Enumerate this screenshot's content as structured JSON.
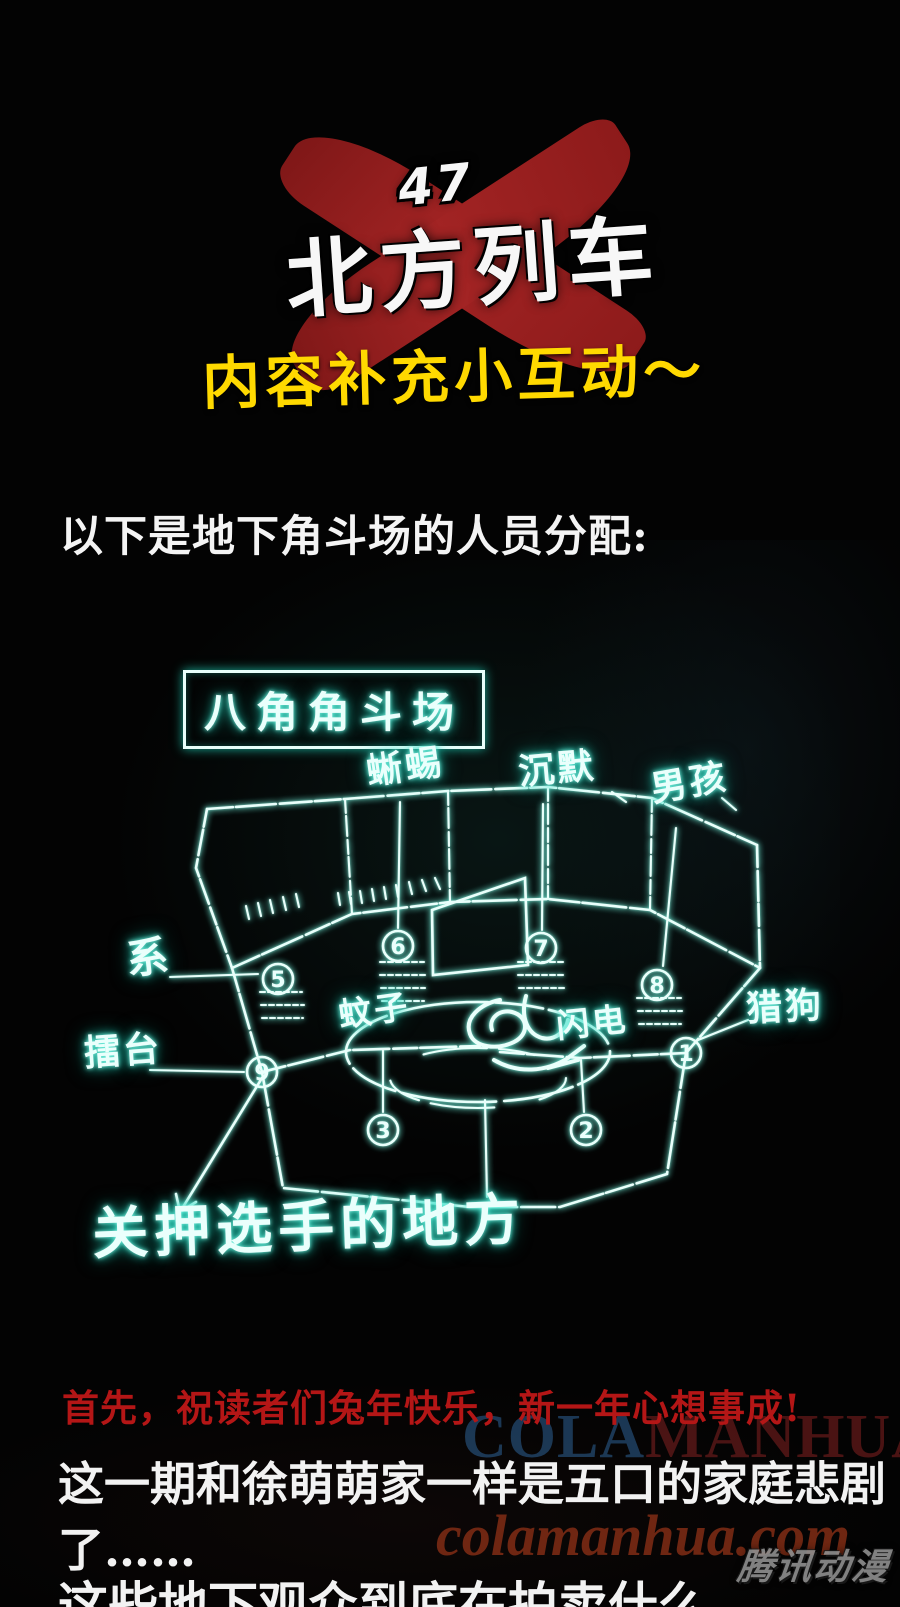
{
  "page": {
    "background": "#030303"
  },
  "header": {
    "series_number": "47",
    "series_title": "北方列车",
    "x_mark_color": "#9c1f1f",
    "subtitle": "内容补充小互动～",
    "subtitle_color": "#ffd900"
  },
  "intro": {
    "text": "以下是地下角斗场的人员分配:"
  },
  "diagram": {
    "neon_color": "#bdfdf2",
    "glow_color": "#1fd6bd",
    "box_label": "八角角斗场",
    "labels": {
      "lizard": "蜥蜴",
      "silence": "沉默",
      "boy": "男孩",
      "tether": "系",
      "stage": "擂台",
      "hound": "猎狗",
      "mosquito": "蚊子",
      "flash": "闪电",
      "holding_area": "关押选手的地方"
    },
    "numbers": [
      "1",
      "2",
      "3",
      "5",
      "6",
      "7",
      "8",
      "9"
    ]
  },
  "footer": {
    "greeting": "首先，祝读者们兔年快乐，新一年心想事成!",
    "greeting_color": "#b41616",
    "line1": "这一期和徐萌萌家一样是五口的家庭悲剧了……",
    "line2": "这些地下观众到底在拍卖什么，",
    "watermark_caps_left": "COLA",
    "watermark_caps_right": "MANHUA",
    "watermark_site": "colamanhua.com",
    "platform_logo": "腾讯动漫"
  }
}
